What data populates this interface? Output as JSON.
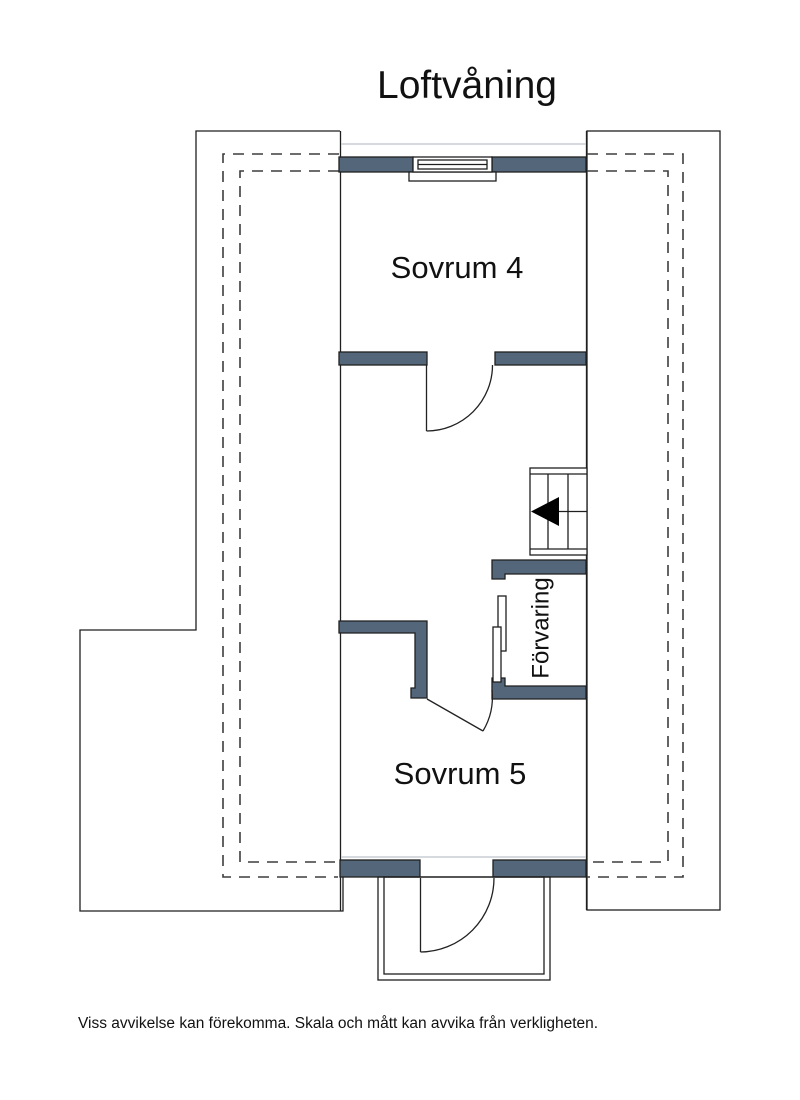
{
  "title": "Loftvåning",
  "plan": {
    "rooms": [
      {
        "id": "sovrum4",
        "label": "Sovrum 4"
      },
      {
        "id": "sovrum5",
        "label": "Sovrum 5"
      },
      {
        "id": "forvaring",
        "label": "Förvaring"
      }
    ],
    "stairs": {
      "direction_arrow": "left"
    }
  },
  "footer": {
    "disclaimer": "Viss avvikelse kan förekomma. Skala och mått kan avvika från verkligheten."
  },
  "colors": {
    "wall_fill": "#53667a",
    "line": "#1f1f1f",
    "dashed_line": "#3d3d3d",
    "faint_line": "#c9ced4",
    "text": "#111111",
    "background": "#ffffff"
  }
}
